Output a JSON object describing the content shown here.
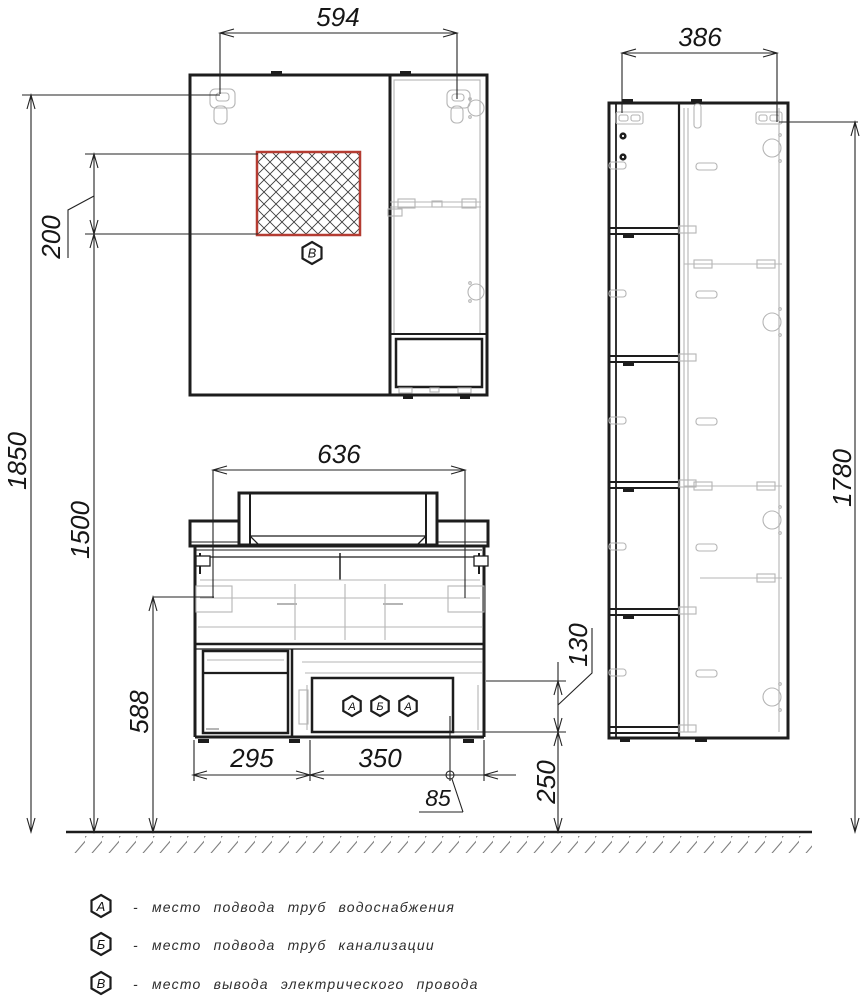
{
  "drawing": {
    "type": "furniture installation dimension drawing",
    "dimension_labels": {
      "d594": "594",
      "d386": "386",
      "d636": "636",
      "d1850": "1850",
      "d1500": "1500",
      "d200": "200",
      "d588": "588",
      "d1780": "1780",
      "d295": "295",
      "d350": "350",
      "d85": "85",
      "d130": "130",
      "d250": "250"
    },
    "markers": {
      "electric": "В",
      "water_left": "А",
      "sewage": "Б",
      "water_right": "А"
    },
    "legend": {
      "items": [
        {
          "symbol": "А",
          "dash": "-",
          "label": "место подвода труб водоснабжения"
        },
        {
          "symbol": "Б",
          "dash": "-",
          "label": "место подвода труб канализации"
        },
        {
          "symbol": "В",
          "dash": "-",
          "label": "место вывода электрического провода"
        }
      ]
    },
    "colors": {
      "line": "#1d1d1d",
      "light_detail": "#b5b5b5",
      "outlet_red": "#b43c32",
      "hatch": "#3d3d3d",
      "floor_hatch": "#7f7f7f"
    }
  }
}
